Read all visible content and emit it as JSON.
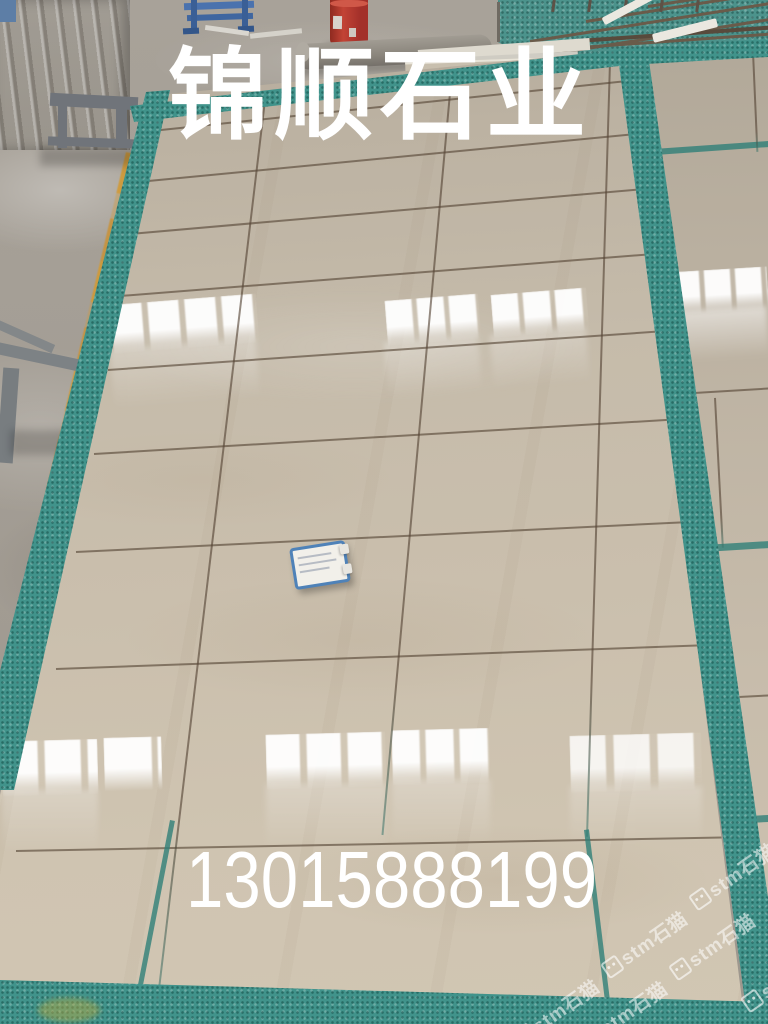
{
  "overlay": {
    "company_name": "锦顺石业",
    "phone_number": "13015888199"
  },
  "watermark": {
    "text": "stm石猫",
    "icon": "cat-logo-icon",
    "count": 6
  },
  "colors": {
    "tile_beige": "#c6bcab",
    "mat_teal": "#41938b",
    "concrete_gray": "#a39d94",
    "floor_line_yellow": "#d09a3d",
    "drum_red": "#b5372a",
    "rack_blue": "#4a72ae",
    "tag_blue": "#4f82b8",
    "overlay_text": "#ffffff"
  }
}
